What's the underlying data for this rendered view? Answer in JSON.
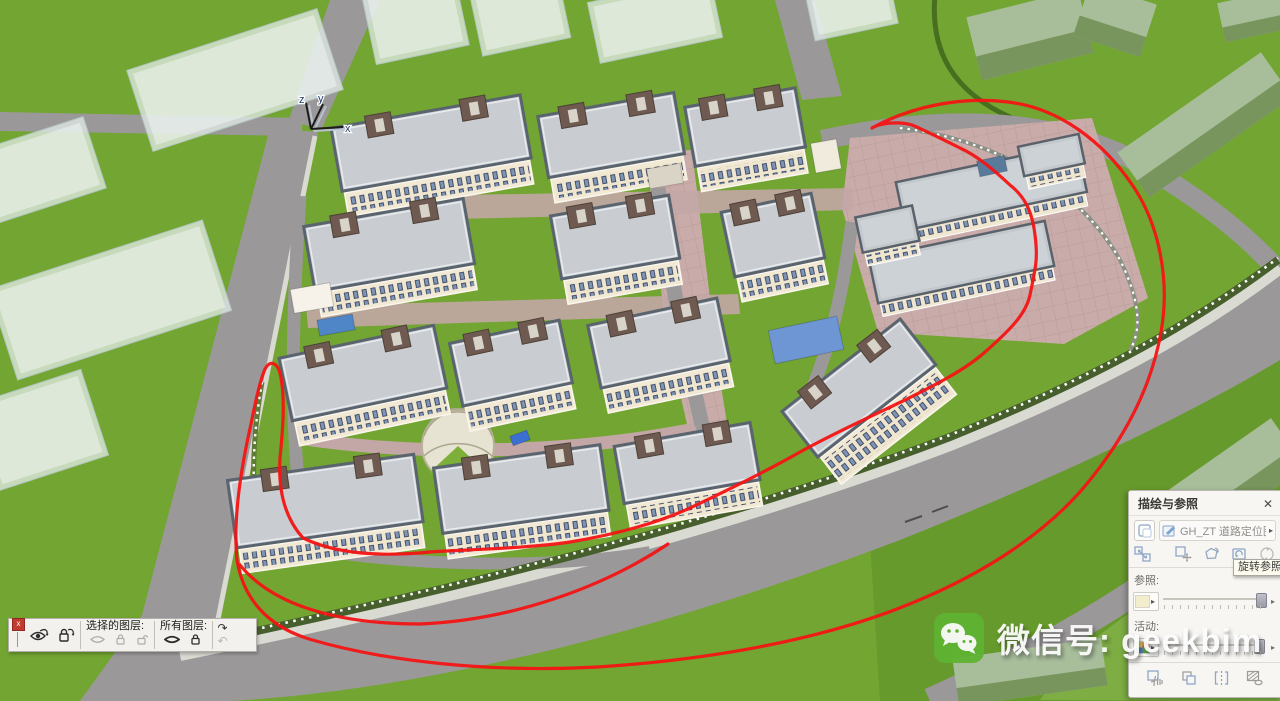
{
  "viewport": {
    "axis": {
      "x": "x",
      "y": "y",
      "z": "z"
    }
  },
  "annotation": {
    "color": "#f41414",
    "shape": "freehand-loop"
  },
  "layer_toolbar": {
    "close_glyph": "x",
    "selected_layers_label": "选择的图层:",
    "all_layers_label": "所有图层:",
    "redo_glyph": "↷",
    "undo_glyph": "↶"
  },
  "trace_panel": {
    "title": "描绘与参照",
    "close_glyph": "✕",
    "reference_name": "GH_ZT 道路定位图 ...",
    "picker_arrow": "▸",
    "tooltip": "旋转参照",
    "reference_label": "参照:",
    "active_label": "活动:",
    "reference_opacity_pct": 95,
    "active_opacity_pct": 90,
    "swatch_arrow": "▸",
    "row_arrow": "▸"
  },
  "watermark": {
    "text": "微信号: geekbim"
  },
  "scene": {
    "colors": {
      "grass": "#72a531",
      "road": "#9b989a",
      "sidewalk": "#d9dad2",
      "paving": "#c9aca9",
      "roof": "#c9cdd2",
      "facade": "#f2e9d5",
      "core": "#6e5a50",
      "annotation": "#f41414"
    },
    "buildings": [
      {
        "t": "ghost",
        "x": 235,
        "y": 80,
        "w": 200,
        "h": 85,
        "a": -18
      },
      {
        "t": "ghost",
        "x": 415,
        "y": 18,
        "w": 95,
        "h": 75,
        "a": -12
      },
      {
        "t": "ghost",
        "x": 520,
        "y": 15,
        "w": 90,
        "h": 65,
        "a": -12
      },
      {
        "t": "ghost",
        "x": 655,
        "y": 20,
        "w": 125,
        "h": 62,
        "a": -12
      },
      {
        "t": "ghost",
        "x": 852,
        "y": 10,
        "w": 85,
        "h": 45,
        "a": -12
      },
      {
        "t": "ghost",
        "x": 40,
        "y": 170,
        "w": 115,
        "h": 75,
        "a": -18
      },
      {
        "t": "ghost",
        "x": 110,
        "y": 300,
        "w": 225,
        "h": 95,
        "a": -18
      },
      {
        "t": "ghost",
        "x": 40,
        "y": 430,
        "w": 115,
        "h": 90,
        "a": -18
      },
      {
        "t": "sage",
        "x": 1030,
        "y": 35,
        "w": 115,
        "h": 65,
        "a": -14
      },
      {
        "t": "sage",
        "x": 1115,
        "y": 20,
        "w": 70,
        "h": 55,
        "a": 18
      },
      {
        "t": "sage",
        "x": 1205,
        "y": 125,
        "w": 175,
        "h": 55,
        "a": -35
      },
      {
        "t": "sage",
        "x": 1258,
        "y": 15,
        "w": 75,
        "h": 40,
        "a": -12
      },
      {
        "t": "sage",
        "x": 1235,
        "y": 480,
        "w": 130,
        "h": 60,
        "a": -35
      },
      {
        "t": "sage",
        "x": 1030,
        "y": 672,
        "w": 150,
        "h": 48,
        "a": -8
      },
      {
        "t": "res",
        "x": 432,
        "y": 148,
        "w": 192,
        "h": 74,
        "a": -10
      },
      {
        "t": "res",
        "x": 612,
        "y": 140,
        "w": 138,
        "h": 72,
        "a": -10
      },
      {
        "t": "res",
        "x": 746,
        "y": 132,
        "w": 112,
        "h": 70,
        "a": -10
      },
      {
        "t": "box",
        "x": 665,
        "y": 176,
        "w": 34,
        "h": 20,
        "a": -10,
        "fill": "#d9d4c6"
      },
      {
        "t": "box",
        "x": 826,
        "y": 156,
        "w": 26,
        "h": 30,
        "a": -10,
        "fill": "#f0ebdd"
      },
      {
        "t": "res",
        "x": 390,
        "y": 250,
        "w": 162,
        "h": 76,
        "a": -10
      },
      {
        "t": "res",
        "x": 616,
        "y": 242,
        "w": 120,
        "h": 74,
        "a": -10
      },
      {
        "t": "res",
        "x": 774,
        "y": 240,
        "w": 92,
        "h": 76,
        "a": -12
      },
      {
        "t": "box",
        "x": 312,
        "y": 298,
        "w": 40,
        "h": 24,
        "a": -10,
        "fill": "#f6f2ea"
      },
      {
        "t": "box",
        "x": 336,
        "y": 325,
        "w": 36,
        "h": 16,
        "a": -10,
        "fill": "#4f86c8"
      },
      {
        "t": "res",
        "x": 364,
        "y": 378,
        "w": 158,
        "h": 74,
        "a": -12
      },
      {
        "t": "res",
        "x": 512,
        "y": 368,
        "w": 112,
        "h": 74,
        "a": -12
      },
      {
        "t": "res",
        "x": 660,
        "y": 348,
        "w": 132,
        "h": 74,
        "a": -12
      },
      {
        "t": "tall",
        "x": 862,
        "y": 392,
        "w": 150,
        "h": 68,
        "a": -38
      },
      {
        "t": "box",
        "x": 806,
        "y": 340,
        "w": 70,
        "h": 34,
        "a": -12,
        "fill": "#6e95d4"
      },
      {
        "t": "res",
        "x": 326,
        "y": 506,
        "w": 188,
        "h": 78,
        "a": -8
      },
      {
        "t": "res",
        "x": 522,
        "y": 494,
        "w": 168,
        "h": 76,
        "a": -8
      },
      {
        "t": "res",
        "x": 688,
        "y": 468,
        "w": 138,
        "h": 68,
        "a": -10
      },
      {
        "t": "comm",
        "x": 992,
        "y": 190,
        "w": 185,
        "h": 55,
        "a": -12
      },
      {
        "t": "comm",
        "x": 962,
        "y": 265,
        "w": 180,
        "h": 52,
        "a": -12
      },
      {
        "t": "comm",
        "x": 888,
        "y": 232,
        "w": 58,
        "h": 42,
        "a": -12
      },
      {
        "t": "comm",
        "x": 1052,
        "y": 158,
        "w": 62,
        "h": 36,
        "a": -12
      },
      {
        "t": "box",
        "x": 992,
        "y": 166,
        "w": 28,
        "h": 16,
        "a": -12,
        "fill": "#5a7a9b"
      },
      {
        "t": "box",
        "x": 520,
        "y": 438,
        "w": 18,
        "h": 10,
        "a": -20,
        "fill": "#3b6fd4"
      }
    ]
  }
}
